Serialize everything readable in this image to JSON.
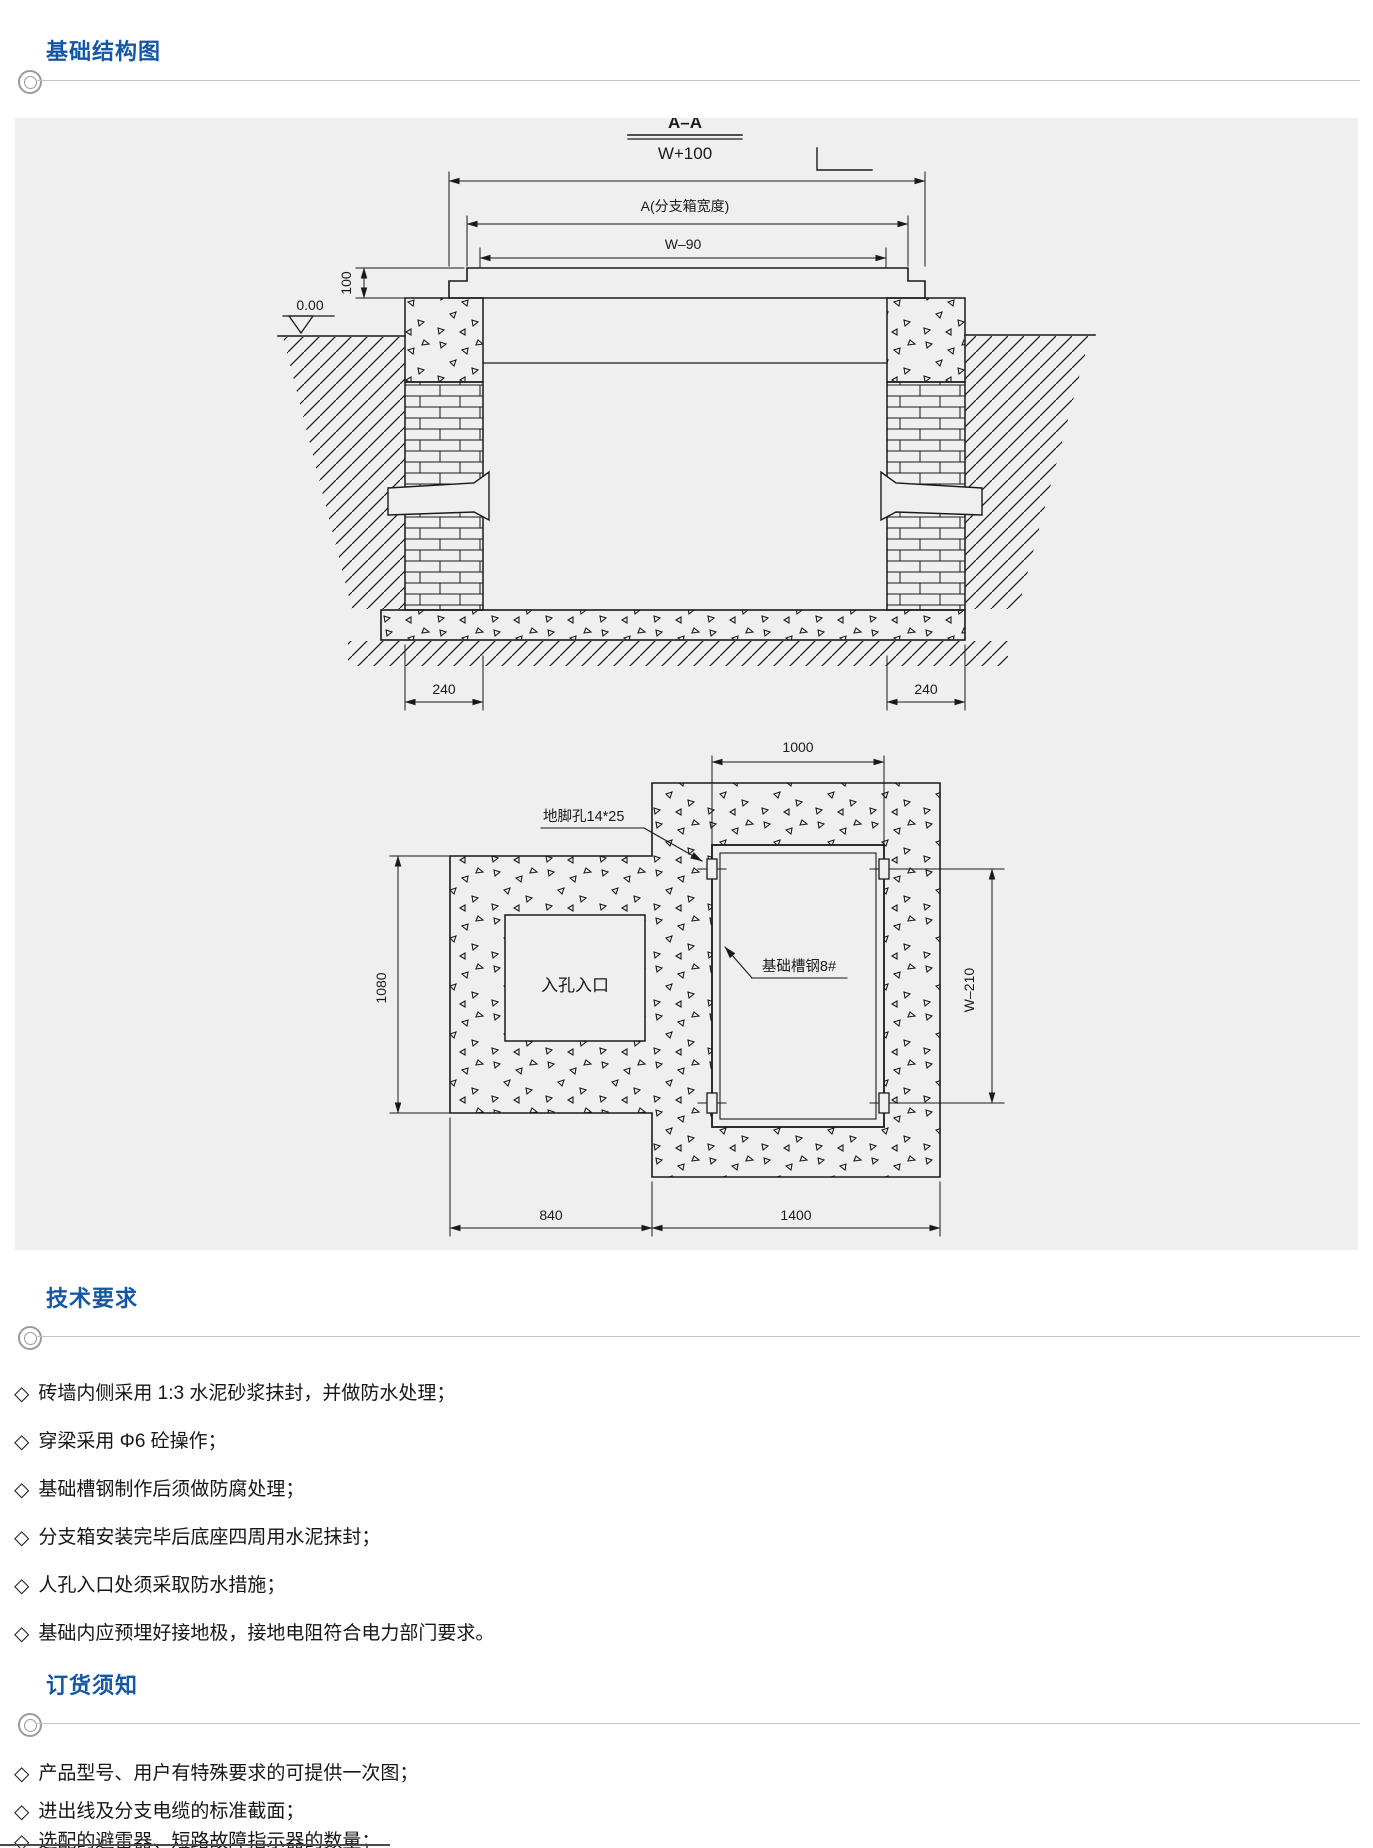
{
  "colors": {
    "header_blue": "#1458A5",
    "panel_bg": "#efefef",
    "line": "#1a1a1a",
    "rule_gray": "#c4c4c4"
  },
  "bullet_char": "◇",
  "sections": {
    "structure": {
      "title": "基础结构图"
    },
    "tech": {
      "title": "技术要求"
    },
    "order": {
      "title": "订货须知"
    }
  },
  "drawing": {
    "section_label": {
      "title": "A–A",
      "subtitle": "W+100"
    },
    "cross_section": {
      "dim_overall_width": "W+100",
      "dim_box_width": "A(分支箱宽度)",
      "dim_inner_width": "W–90",
      "dim_lip_height": "100",
      "level_label": "0.00",
      "dim_wall_left": "240",
      "dim_wall_right": "240"
    },
    "plan_view": {
      "dim_frame_width": "1000",
      "anchor_hole_label": "地脚孔14*25",
      "channel_steel_label": "基础槽钢8#",
      "manhole_label": "入孔入口",
      "dim_left_height": "1080",
      "dim_right_height": "W–210",
      "dim_bottom_left": "840",
      "dim_bottom_right": "1400"
    }
  },
  "tech_requirements": {
    "items": [
      "砖墙内侧采用 1:3 水泥砂浆抹封，并做防水处理；",
      "穿梁采用 Φ6 砼操作；",
      "基础槽钢制作后须做防腐处理；",
      "分支箱安装完毕后底座四周用水泥抹封；",
      "人孔入口处须采取防水措施；",
      "基础内应预埋好接地极，接地电阻符合电力部门要求。"
    ]
  },
  "order_notes": {
    "items": [
      "产品型号、用户有特殊要求的可提供一次图；",
      "进出线及分支电缆的标准截面；",
      "选配的避雷器、短路故障指示器的数量；"
    ]
  }
}
